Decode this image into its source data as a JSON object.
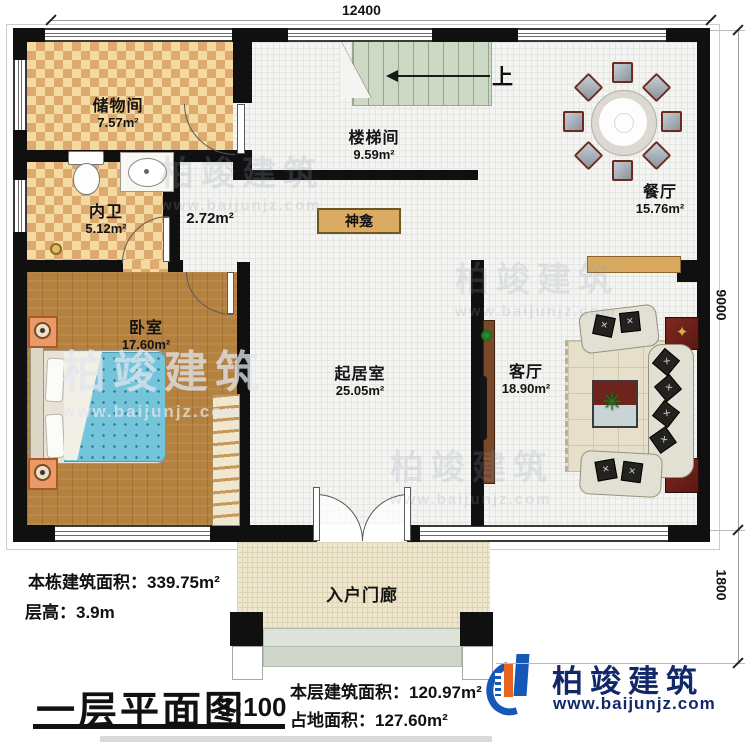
{
  "plan": {
    "dim_top": "12400",
    "dim_right_upper": "9000",
    "dim_right_lower": "1800",
    "up": "上",
    "shrine": "神龛",
    "hall_area": "2.72m²",
    "rooms": [
      {
        "name": "储物间",
        "area": "7.57m²"
      },
      {
        "name": "内卫",
        "area": "5.12m²"
      },
      {
        "name": "楼梯间",
        "area": "9.59m²"
      },
      {
        "name": "餐厅",
        "area": "15.76m²"
      },
      {
        "name": "卧室",
        "area": "17.60m²"
      },
      {
        "name": "起居室",
        "area": "25.05m²"
      },
      {
        "name": "客厅",
        "area": "18.90m²"
      },
      {
        "name": "入户门廊",
        "area": ""
      }
    ]
  },
  "footer": {
    "total_area": "本栋建筑面积：339.75m²",
    "floor_height": "层高：3.9m",
    "title": "一层平面图",
    "scale": "1:100",
    "floor_area": "本层建筑面积：120.97m²",
    "footprint": "占地面积：127.60m²"
  },
  "brand": {
    "name": "柏竣建筑",
    "url": "www.baijunjz.com"
  },
  "watermark": {
    "name": "柏竣建筑",
    "url": "www.baijunjz.com"
  },
  "colors": {
    "wall": "#101010",
    "checker_light": "#f4d9a1",
    "checker_dark": "#dca96e",
    "wood_floor": "#b5813f",
    "stair_green": "#cdd8c5",
    "porch_cream": "#eee7cd",
    "accent_red": "#6e241c",
    "shrine_tan": "#dcab63",
    "bed_blue": "#74c4da",
    "brand_navy": "#13286b",
    "brand_blue": "#1658b8",
    "brand_orange": "#e8641e"
  }
}
